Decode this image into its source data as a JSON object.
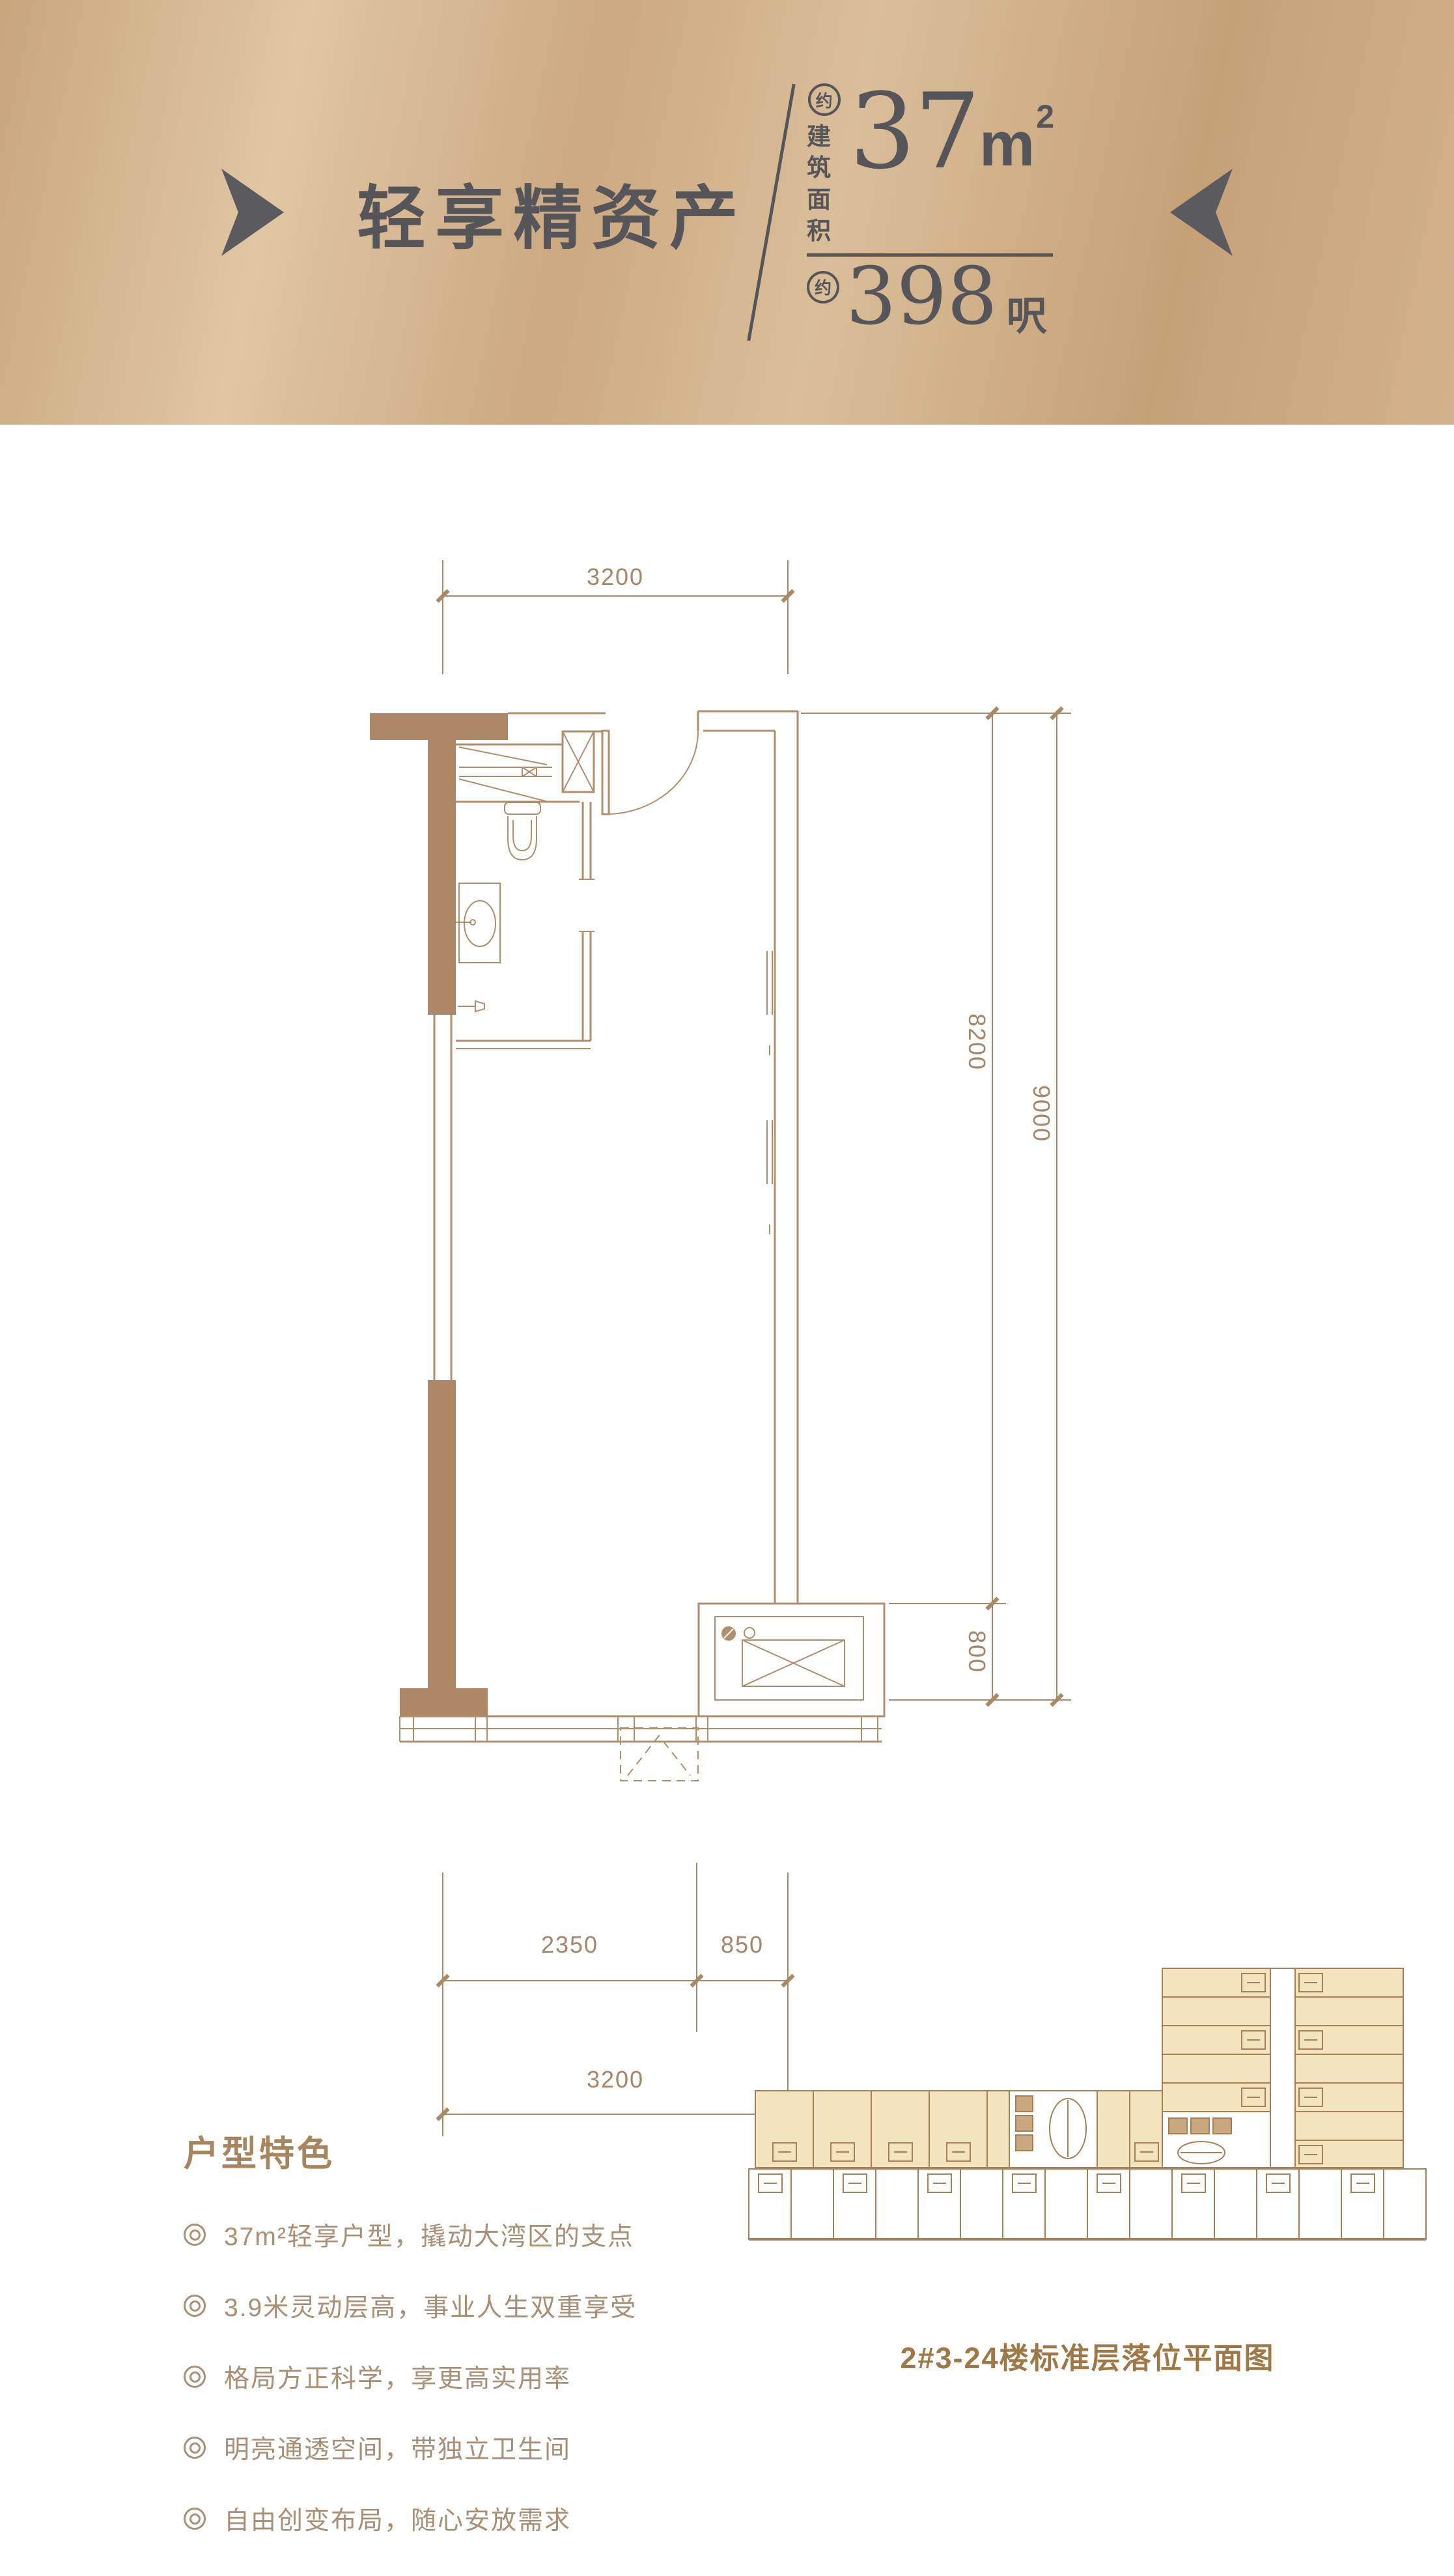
{
  "header": {
    "title": "轻享精资产",
    "area": {
      "approx": "约",
      "label_line1": "建筑",
      "label_line2": "面积",
      "sqm_value": "37",
      "sqm_unit": "m",
      "sqm_sup": "2",
      "sqft_approx": "约",
      "sqft_value": "398",
      "sqft_unit": "呎"
    }
  },
  "floorplan": {
    "dims": {
      "top_width": "3200",
      "right_inner": "8200",
      "right_outer": "9000",
      "kitchen_depth": "800",
      "bottom_left": "2350",
      "bottom_right": "850",
      "bottom_total": "3200"
    }
  },
  "features": {
    "heading": "户型特色",
    "items": [
      "37m²轻享户型，撬动大湾区的支点",
      "3.9米灵动层高，事业人生双重享受",
      "格局方正科学，享更高实用率",
      "明亮通透空间，带独立卫生间",
      "自由创变布局，随心安放需求"
    ]
  },
  "keyplan": {
    "caption": "2#3-24楼标准层落位平面图"
  },
  "colors": {
    "header_gold_light": "#e0c6a3",
    "header_gold_dark": "#c5a178",
    "header_text": "#55555a",
    "plan_line": "#b18e6c",
    "plan_wall_fill": "#ae8767",
    "dim_text": "#a5866a",
    "feature_text": "#a98f75",
    "feature_heading": "#a7855e",
    "keyplan_fill": "#f2e4bf",
    "keyplan_line": "#a87f56",
    "caption_text": "#9e7846"
  }
}
